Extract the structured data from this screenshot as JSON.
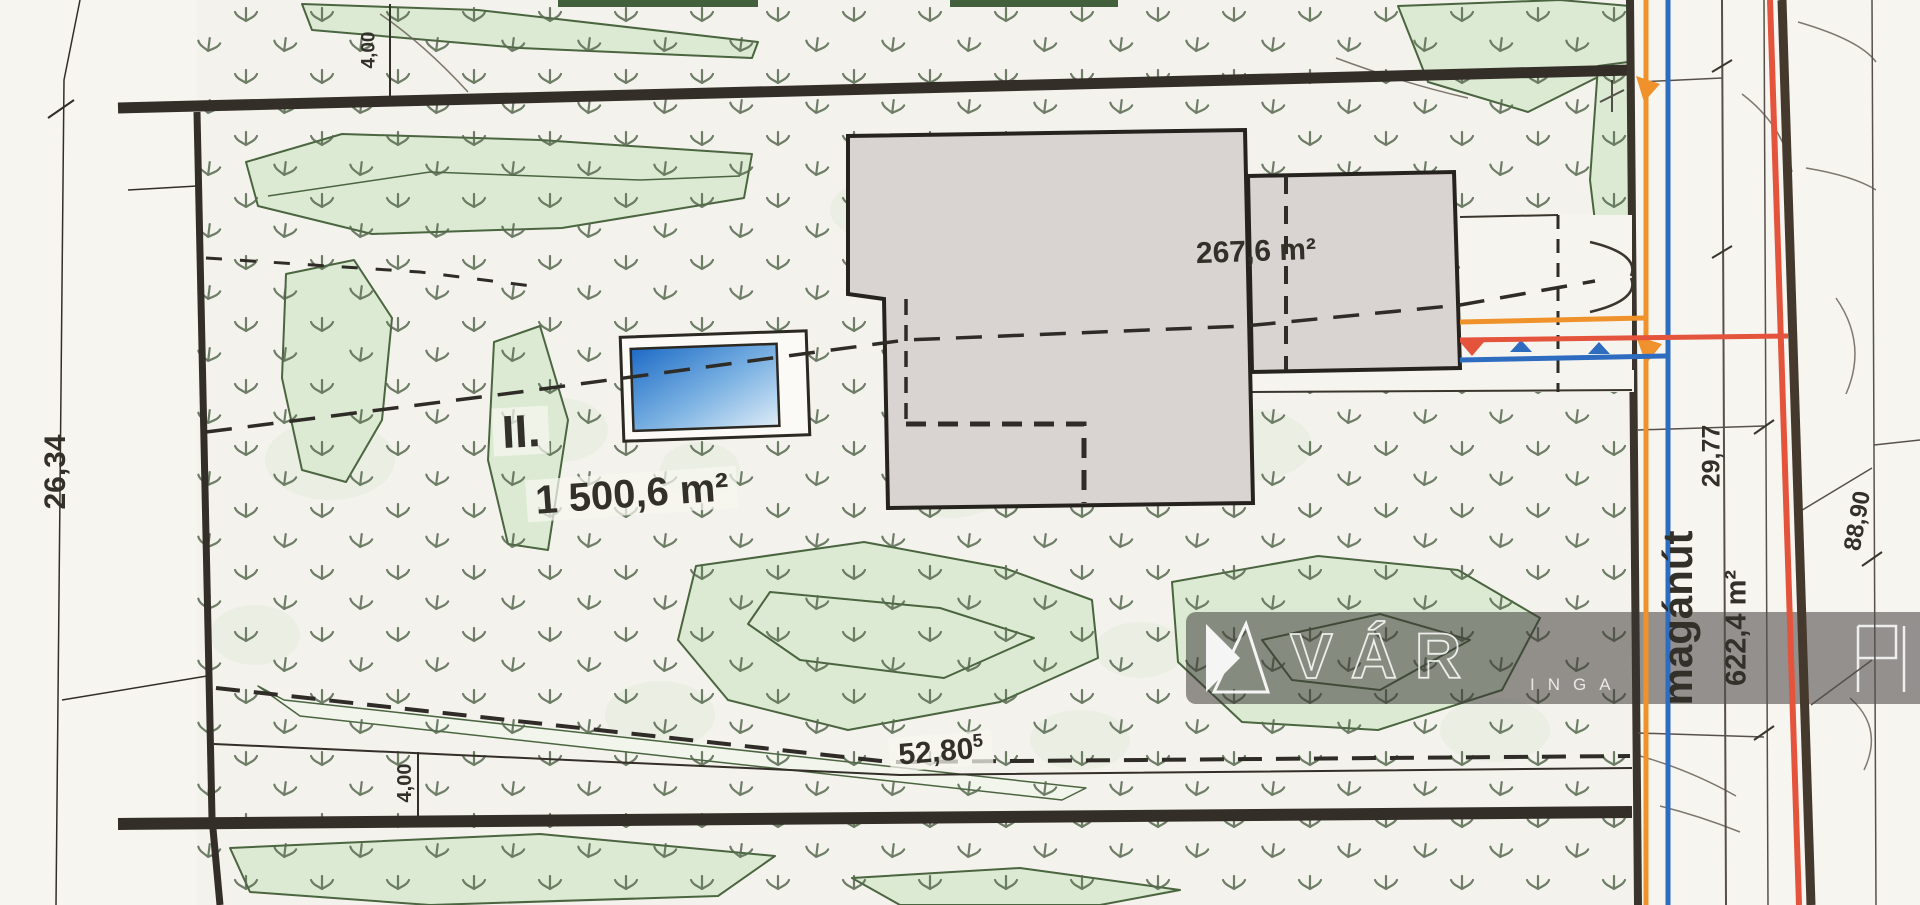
{
  "labels": {
    "dim_left": "26,34",
    "dim_top_strip": "4,00",
    "dim_bottom_strip": "4,00",
    "parcel_number": "II.",
    "parcel_area": "1 500,6 m²",
    "building_area": "267,6 m²",
    "dim_south": "52,80",
    "dim_south_superscript": "5",
    "road_name": "magánút",
    "road_area": "622,4 m²",
    "dim_road_width": "29,77",
    "dim_road_length": "88,90"
  },
  "watermark": {
    "brand_text": "VÁR",
    "small_text": "INGA"
  },
  "colors": {
    "paper": "#f5f3ed",
    "line_dark": "#332e27",
    "grass": "#55684e",
    "vegetation_fill": "#dcead3",
    "vegetation_outline": "#4a653f",
    "building_fill": "#d9d4d2",
    "pool_blue_dark": "#1d6bc6",
    "pool_blue_mid": "#7db3e3",
    "pool_blue_light": "#ddebf7",
    "utility_orange": "#f0922b",
    "utility_blue": "#2e6cc0",
    "utility_red": "#e4543c",
    "road_line_dark": "#45392e"
  }
}
